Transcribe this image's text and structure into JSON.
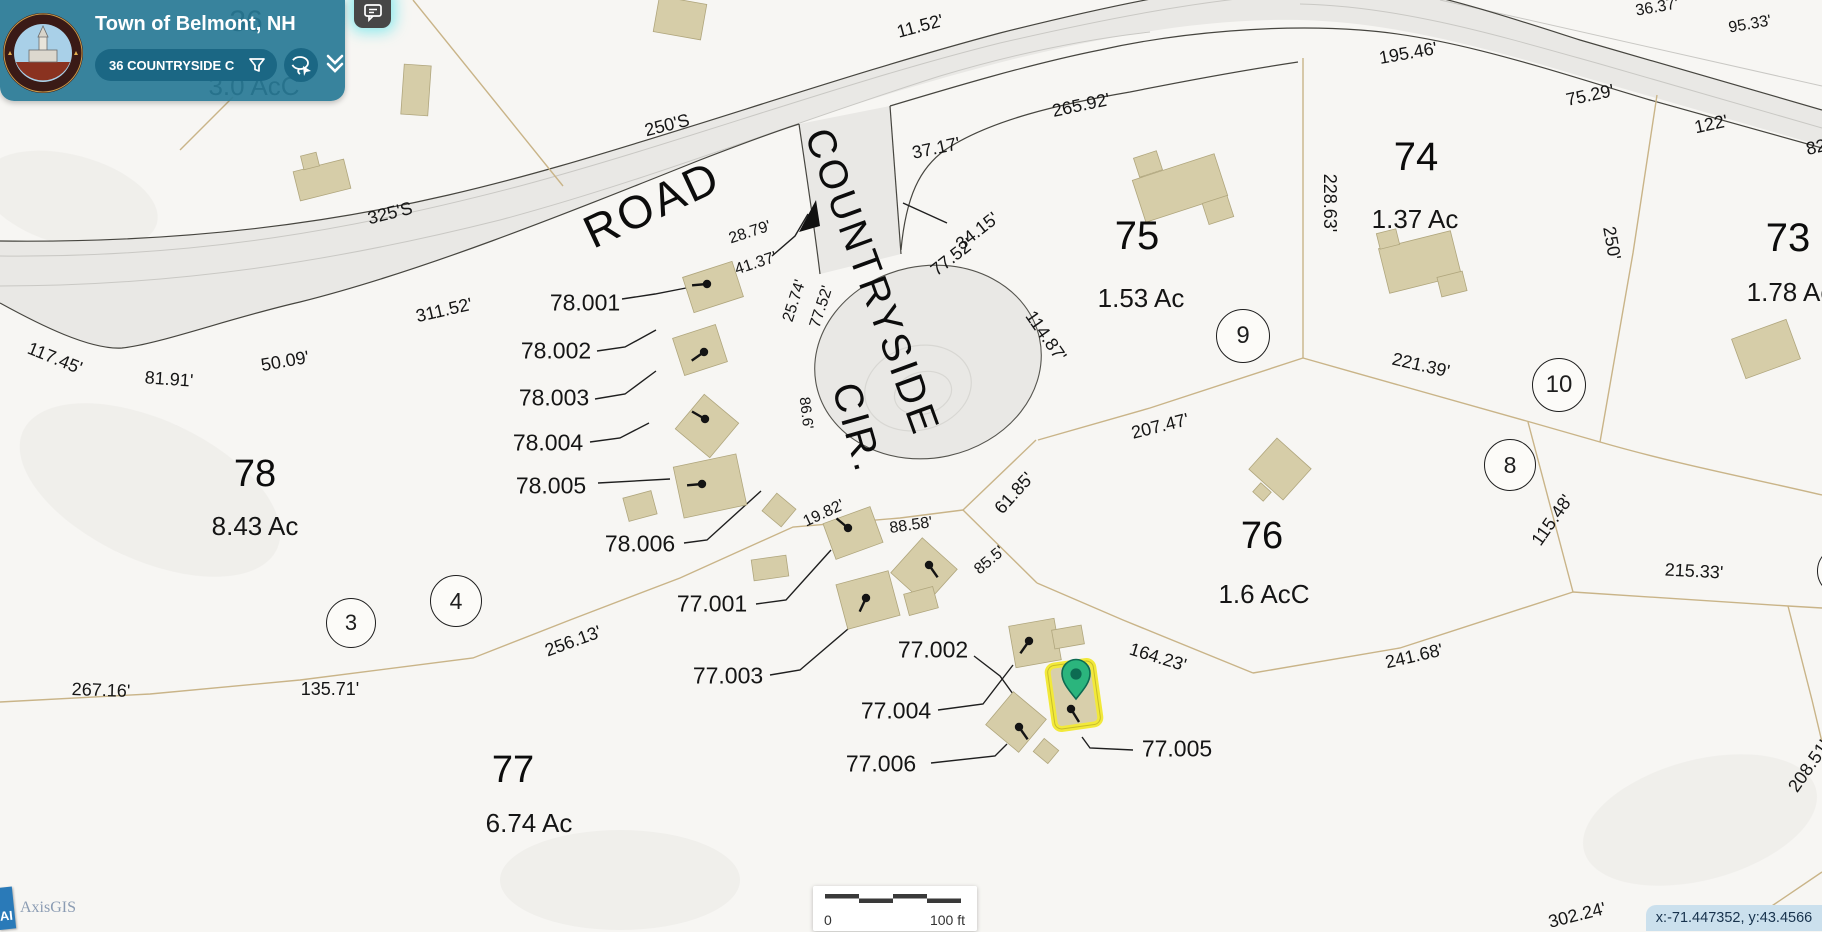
{
  "header": {
    "title": "Town of Belmont, NH",
    "search_value": "36 COUNTRYSIDE C",
    "icons": [
      "filter-funnel-icon",
      "lasso-select-icon",
      "double-chevron-down-icon",
      "comment-icon"
    ]
  },
  "footer": {
    "scalebar": {
      "left_label": "0",
      "right_label": "100 ft"
    },
    "coordinates": "x:-71.447352, y:43.4566",
    "brand": "AxisGIS",
    "brand_badge": "AI"
  },
  "colors": {
    "panel_teal": "#297a96",
    "pill_teal": "#1b6784",
    "road_fill": "#e9e8e5",
    "boundary_tan": "#c9b488",
    "building_tan": "#d6cda8",
    "selected_yellow": "#f2e93a",
    "pin_green": "#2bb57d",
    "pin_dark": "#0d6b52",
    "coord_bar_blue": "#cbe0ed"
  },
  "map": {
    "road_names": [
      {
        "t": "ROAD",
        "x": 652,
        "y": 204,
        "r": -25,
        "s": 46
      },
      {
        "t": "COUNTRYSIDE",
        "x": 872,
        "y": 282,
        "r": 70,
        "s": 40
      },
      {
        "t": "CIR.",
        "x": 857,
        "y": 428,
        "r": 74,
        "s": 40
      }
    ],
    "parcel_numbers": [
      {
        "t": "78",
        "x": 255,
        "y": 474,
        "s": 38
      },
      {
        "t": "77",
        "x": 513,
        "y": 770,
        "s": 38
      },
      {
        "t": "76",
        "x": 1262,
        "y": 536,
        "s": 38
      },
      {
        "t": "75",
        "x": 1137,
        "y": 236,
        "s": 40
      },
      {
        "t": "74",
        "x": 1416,
        "y": 157,
        "s": 40
      },
      {
        "t": "73",
        "x": 1788,
        "y": 238,
        "s": 40
      },
      {
        "t": "36",
        "x": 246,
        "y": 22,
        "s": 30
      }
    ],
    "acreage_labels": [
      {
        "t": "8.43 Ac",
        "x": 255,
        "y": 526,
        "s": 26
      },
      {
        "t": "6.74 Ac",
        "x": 529,
        "y": 823,
        "s": 26
      },
      {
        "t": "1.6 AcC",
        "x": 1264,
        "y": 594,
        "s": 26
      },
      {
        "t": "1.53 Ac",
        "x": 1141,
        "y": 298,
        "s": 26
      },
      {
        "t": "1.37 Ac",
        "x": 1415,
        "y": 219,
        "s": 26
      },
      {
        "t": "1.78 Ac",
        "x": 1790,
        "y": 292,
        "s": 26
      },
      {
        "t": "3.0 AcC",
        "x": 254,
        "y": 86,
        "s": 26
      }
    ],
    "lot_labels": [
      {
        "t": "78.001",
        "x": 585,
        "y": 303
      },
      {
        "t": "78.002",
        "x": 556,
        "y": 351
      },
      {
        "t": "78.003",
        "x": 554,
        "y": 398
      },
      {
        "t": "78.004",
        "x": 548,
        "y": 443
      },
      {
        "t": "78.005",
        "x": 551,
        "y": 486
      },
      {
        "t": "78.006",
        "x": 640,
        "y": 544
      },
      {
        "t": "77.001",
        "x": 712,
        "y": 604
      },
      {
        "t": "77.002",
        "x": 933,
        "y": 650
      },
      {
        "t": "77.003",
        "x": 728,
        "y": 676
      },
      {
        "t": "77.004",
        "x": 896,
        "y": 711
      },
      {
        "t": "77.005",
        "x": 1177,
        "y": 749
      },
      {
        "t": "77.006",
        "x": 881,
        "y": 764
      }
    ],
    "dimension_labels": [
      {
        "t": "11.52'",
        "x": 920,
        "y": 26,
        "r": -15
      },
      {
        "t": "250'S",
        "x": 667,
        "y": 125,
        "r": -14
      },
      {
        "t": "325'S",
        "x": 390,
        "y": 213,
        "r": -14
      },
      {
        "t": "28.79'",
        "x": 750,
        "y": 233,
        "r": -18,
        "s": 16
      },
      {
        "t": "41.37'",
        "x": 756,
        "y": 264,
        "r": -18,
        "s": 16
      },
      {
        "t": "37.17'",
        "x": 936,
        "y": 148,
        "r": -12
      },
      {
        "t": "265.92'",
        "x": 1081,
        "y": 105,
        "r": -12
      },
      {
        "t": "34.15'",
        "x": 977,
        "y": 231,
        "r": -38
      },
      {
        "t": "77.52'",
        "x": 952,
        "y": 257,
        "r": -38
      },
      {
        "t": "25.74'",
        "x": 795,
        "y": 301,
        "r": -72,
        "s": 16
      },
      {
        "t": "77.52'",
        "x": 822,
        "y": 307,
        "r": -72,
        "s": 16
      },
      {
        "t": "86.6'",
        "x": 806,
        "y": 413,
        "r": 83,
        "s": 15
      },
      {
        "t": "114.87'",
        "x": 1046,
        "y": 336,
        "r": 55
      },
      {
        "t": "195.46'",
        "x": 1408,
        "y": 53,
        "r": -10
      },
      {
        "t": "75.29'",
        "x": 1590,
        "y": 95,
        "r": -12
      },
      {
        "t": "36.37'",
        "x": 1657,
        "y": 8,
        "r": -10,
        "s": 16
      },
      {
        "t": "95.33'",
        "x": 1750,
        "y": 25,
        "r": -10,
        "s": 16
      },
      {
        "t": "122'",
        "x": 1711,
        "y": 124,
        "r": -12
      },
      {
        "t": "82",
        "x": 1816,
        "y": 147,
        "r": -12
      },
      {
        "t": "228.63'",
        "x": 1330,
        "y": 203,
        "r": 90
      },
      {
        "t": "250'",
        "x": 1612,
        "y": 243,
        "r": 80
      },
      {
        "t": "221.39'",
        "x": 1421,
        "y": 365,
        "r": 13
      },
      {
        "t": "207.47'",
        "x": 1160,
        "y": 426,
        "r": -14
      },
      {
        "t": "115.48'",
        "x": 1552,
        "y": 520,
        "r": -55
      },
      {
        "t": "215.33'",
        "x": 1694,
        "y": 571,
        "r": 3
      },
      {
        "t": "241.68'",
        "x": 1414,
        "y": 656,
        "r": -13
      },
      {
        "t": "164.23'",
        "x": 1158,
        "y": 657,
        "r": 17
      },
      {
        "t": "208.51'",
        "x": 1809,
        "y": 766,
        "r": -55
      },
      {
        "t": "302.24'",
        "x": 1577,
        "y": 915,
        "r": -14
      },
      {
        "t": "61.85'",
        "x": 1014,
        "y": 493,
        "r": -48
      },
      {
        "t": "85.5'",
        "x": 990,
        "y": 561,
        "r": -40,
        "s": 16
      },
      {
        "t": "88.58'",
        "x": 911,
        "y": 526,
        "r": -8,
        "s": 16
      },
      {
        "t": "19.82'",
        "x": 824,
        "y": 514,
        "r": -25,
        "s": 16
      },
      {
        "t": "117.45'",
        "x": 55,
        "y": 358,
        "r": 22
      },
      {
        "t": "81.91'",
        "x": 169,
        "y": 379,
        "r": 4
      },
      {
        "t": "50.09'",
        "x": 285,
        "y": 361,
        "r": -10
      },
      {
        "t": "311.52'",
        "x": 444,
        "y": 310,
        "r": -13
      },
      {
        "t": "267.16'",
        "x": 101,
        "y": 690,
        "r": 2
      },
      {
        "t": "135.71'",
        "x": 330,
        "y": 689,
        "r": 0
      },
      {
        "t": "256.13'",
        "x": 573,
        "y": 641,
        "r": -20
      }
    ],
    "circle_markers": [
      {
        "n": "3",
        "x": 350,
        "y": 622,
        "d": 48
      },
      {
        "n": "4",
        "x": 455,
        "y": 600,
        "d": 50
      },
      {
        "n": "8",
        "x": 1509,
        "y": 464,
        "d": 50
      },
      {
        "n": "9",
        "x": 1242,
        "y": 335,
        "d": 52
      },
      {
        "n": "10",
        "x": 1558,
        "y": 384,
        "d": 52
      },
      {
        "n": "",
        "x": 1841,
        "y": 570,
        "d": 48
      }
    ],
    "buildings": [
      {
        "cx": 680,
        "cy": 18,
        "w": 48,
        "h": 36,
        "rot": 10
      },
      {
        "cx": 416,
        "cy": 90,
        "w": 27,
        "h": 50,
        "rot": 4
      },
      {
        "cx": 322,
        "cy": 180,
        "w": 52,
        "h": 30,
        "rot": -14
      },
      {
        "cx": 310,
        "cy": 161,
        "w": 16,
        "h": 14,
        "rot": -14
      },
      {
        "cx": 713,
        "cy": 287,
        "w": 52,
        "h": 37,
        "rot": -18
      },
      {
        "cx": 700,
        "cy": 350,
        "w": 45,
        "h": 39,
        "rot": -18
      },
      {
        "cx": 707,
        "cy": 426,
        "w": 45,
        "h": 45,
        "rot": 40
      },
      {
        "cx": 710,
        "cy": 486,
        "w": 64,
        "h": 52,
        "rot": -12
      },
      {
        "cx": 853,
        "cy": 533,
        "w": 50,
        "h": 38,
        "rot": -20
      },
      {
        "cx": 868,
        "cy": 600,
        "w": 54,
        "h": 46,
        "rot": -15
      },
      {
        "cx": 924,
        "cy": 571,
        "w": 47,
        "h": 47,
        "rot": 42
      },
      {
        "cx": 921,
        "cy": 601,
        "w": 30,
        "h": 22,
        "rot": -15
      },
      {
        "cx": 1035,
        "cy": 643,
        "w": 46,
        "h": 42,
        "rot": -10
      },
      {
        "cx": 1068,
        "cy": 637,
        "w": 30,
        "h": 19,
        "rot": -10
      },
      {
        "cx": 1016,
        "cy": 722,
        "w": 43,
        "h": 43,
        "rot": 40
      },
      {
        "cx": 640,
        "cy": 506,
        "w": 29,
        "h": 24,
        "rot": -15
      },
      {
        "cx": 779,
        "cy": 510,
        "w": 25,
        "h": 23,
        "rot": 40
      },
      {
        "cx": 770,
        "cy": 568,
        "w": 35,
        "h": 21,
        "rot": -8
      },
      {
        "cx": 1046,
        "cy": 751,
        "w": 19,
        "h": 17,
        "rot": 40
      },
      {
        "cx": 1180,
        "cy": 188,
        "w": 86,
        "h": 44,
        "rot": -18
      },
      {
        "cx": 1148,
        "cy": 164,
        "w": 24,
        "h": 20,
        "rot": -18
      },
      {
        "cx": 1218,
        "cy": 210,
        "w": 26,
        "h": 22,
        "rot": -18
      },
      {
        "cx": 1420,
        "cy": 262,
        "w": 74,
        "h": 46,
        "rot": -14
      },
      {
        "cx": 1452,
        "cy": 284,
        "w": 26,
        "h": 20,
        "rot": -14
      },
      {
        "cx": 1388,
        "cy": 239,
        "w": 20,
        "h": 16,
        "rot": -14
      },
      {
        "cx": 1766,
        "cy": 349,
        "w": 58,
        "h": 42,
        "rot": -20
      },
      {
        "cx": 1280,
        "cy": 469,
        "w": 46,
        "h": 42,
        "rot": 42
      },
      {
        "cx": 1262,
        "cy": 492,
        "w": 14,
        "h": 12,
        "rot": 42
      }
    ],
    "well_symbols": [
      {
        "x": 707,
        "y": 284,
        "a": 185
      },
      {
        "x": 704,
        "y": 352,
        "a": 215
      },
      {
        "x": 705,
        "y": 419,
        "a": 150
      },
      {
        "x": 702,
        "y": 484,
        "a": 185
      },
      {
        "x": 848,
        "y": 528,
        "a": 140
      },
      {
        "x": 866,
        "y": 598,
        "a": 245
      },
      {
        "x": 929,
        "y": 565,
        "a": 305
      },
      {
        "x": 1029,
        "y": 641,
        "a": 235
      },
      {
        "x": 1019,
        "y": 727,
        "a": 305
      }
    ],
    "selected_parcel": {
      "cx": 1074,
      "cy": 695,
      "w": 46,
      "h": 64,
      "rot": -8,
      "pin": {
        "x": 1076,
        "y": 678
      }
    }
  }
}
